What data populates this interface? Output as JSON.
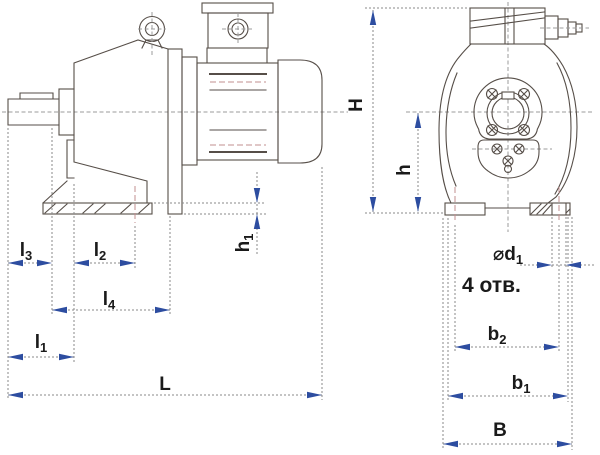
{
  "labels": {
    "H": {
      "main": "H",
      "sub": ""
    },
    "h": {
      "main": "h",
      "sub": ""
    },
    "h1": {
      "main": "h",
      "sub": "1"
    },
    "l1": {
      "main": "l",
      "sub": "1"
    },
    "l2": {
      "main": "l",
      "sub": "2"
    },
    "l3": {
      "main": "l",
      "sub": "3"
    },
    "l4": {
      "main": "l",
      "sub": "4"
    },
    "L": {
      "main": "L",
      "sub": ""
    },
    "d1": {
      "main": "⌀d",
      "sub": "1"
    },
    "holes_note": "4 отв.",
    "b2": {
      "main": "b",
      "sub": "2"
    },
    "b1": {
      "main": "b",
      "sub": "1"
    },
    "B": {
      "main": "B",
      "sub": ""
    }
  },
  "colors": {
    "outline": "#564e48",
    "centerline": "#9b9b9b",
    "hidden": "#c28f8f",
    "dimension": "#8a8a8a",
    "arrow": "#2d4da0",
    "text": "#1a1a1a",
    "background": "#ffffff"
  }
}
